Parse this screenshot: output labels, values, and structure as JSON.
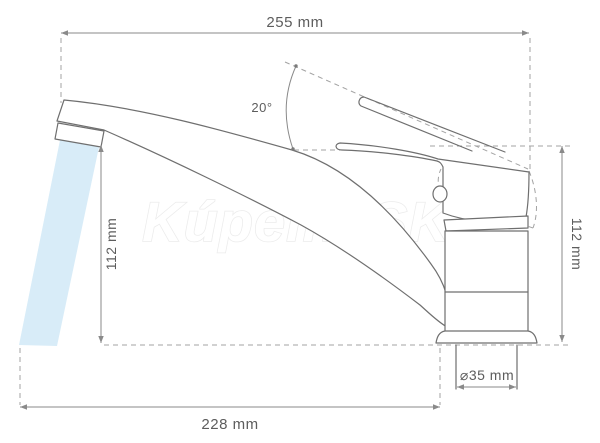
{
  "diagram": {
    "watermark": "KúpelneSK",
    "dimensions": {
      "top_width": "255 mm",
      "left_height": "112 mm",
      "right_height": "112 mm",
      "bottom_width": "228 mm",
      "base_diameter": "⌀35 mm",
      "lever_angle": "20°"
    },
    "colors": {
      "line": "#6f6f6f",
      "dashed_line": "#a3a3a3",
      "dimension_text": "#5d5d5d",
      "water": "#d8ecf8",
      "watermark_outline": "#ebebeb",
      "background": "#ffffff"
    }
  }
}
